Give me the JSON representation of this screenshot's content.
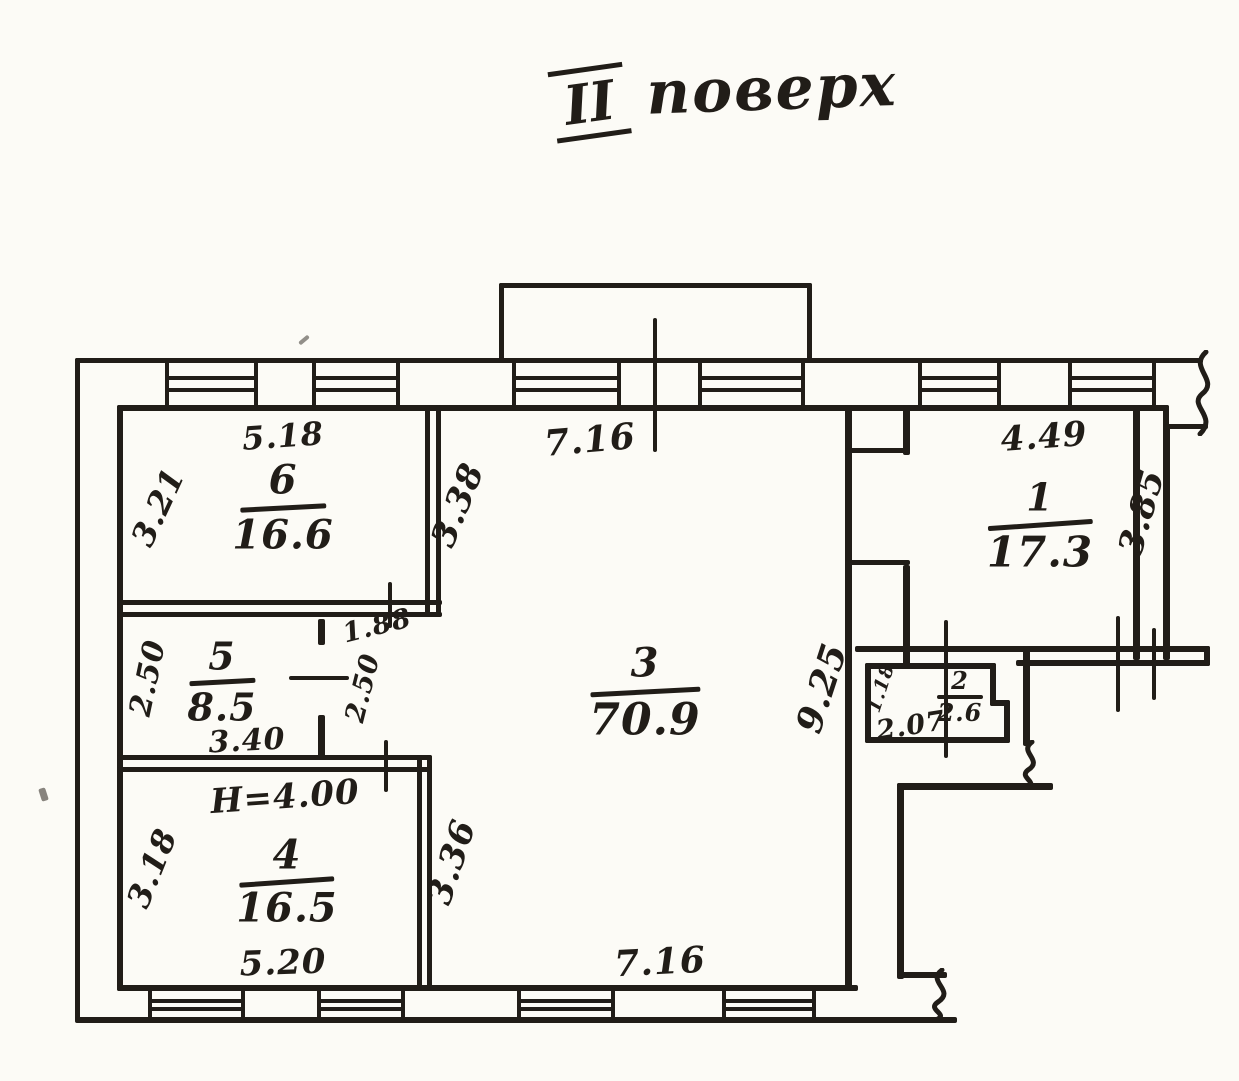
{
  "title": {
    "roman": "II",
    "word": "поверх"
  },
  "rooms": {
    "r1": {
      "number": "1",
      "area": "17.3",
      "dim_top": "4.49",
      "dim_right": "3.85"
    },
    "r2": {
      "number": "2",
      "area": "2.6",
      "dim_left": "1.18",
      "dim_bottom": "2.07"
    },
    "r3": {
      "number": "3",
      "area": "70.9",
      "dim_top": "7.16",
      "dim_bottom": "7.16",
      "dim_left_upper": "3.38",
      "dim_left_lower": "3.36",
      "dim_right": "9.25"
    },
    "r4": {
      "number": "4",
      "area": "16.5",
      "dim_left": "3.18",
      "dim_bottom": "5.20",
      "height_note": "H=4.00"
    },
    "r5": {
      "number": "5",
      "area": "8.5",
      "dim_left": "2.50",
      "dim_bottom": "3.40"
    },
    "r6": {
      "number": "6",
      "area": "16.6",
      "dim_top": "5.18",
      "dim_left": "3.21"
    }
  },
  "niche": {
    "dim_width": "1.88",
    "dim_height": "2.50"
  },
  "colors": {
    "ink": "#211d18",
    "paper": "#fcfbf6"
  }
}
